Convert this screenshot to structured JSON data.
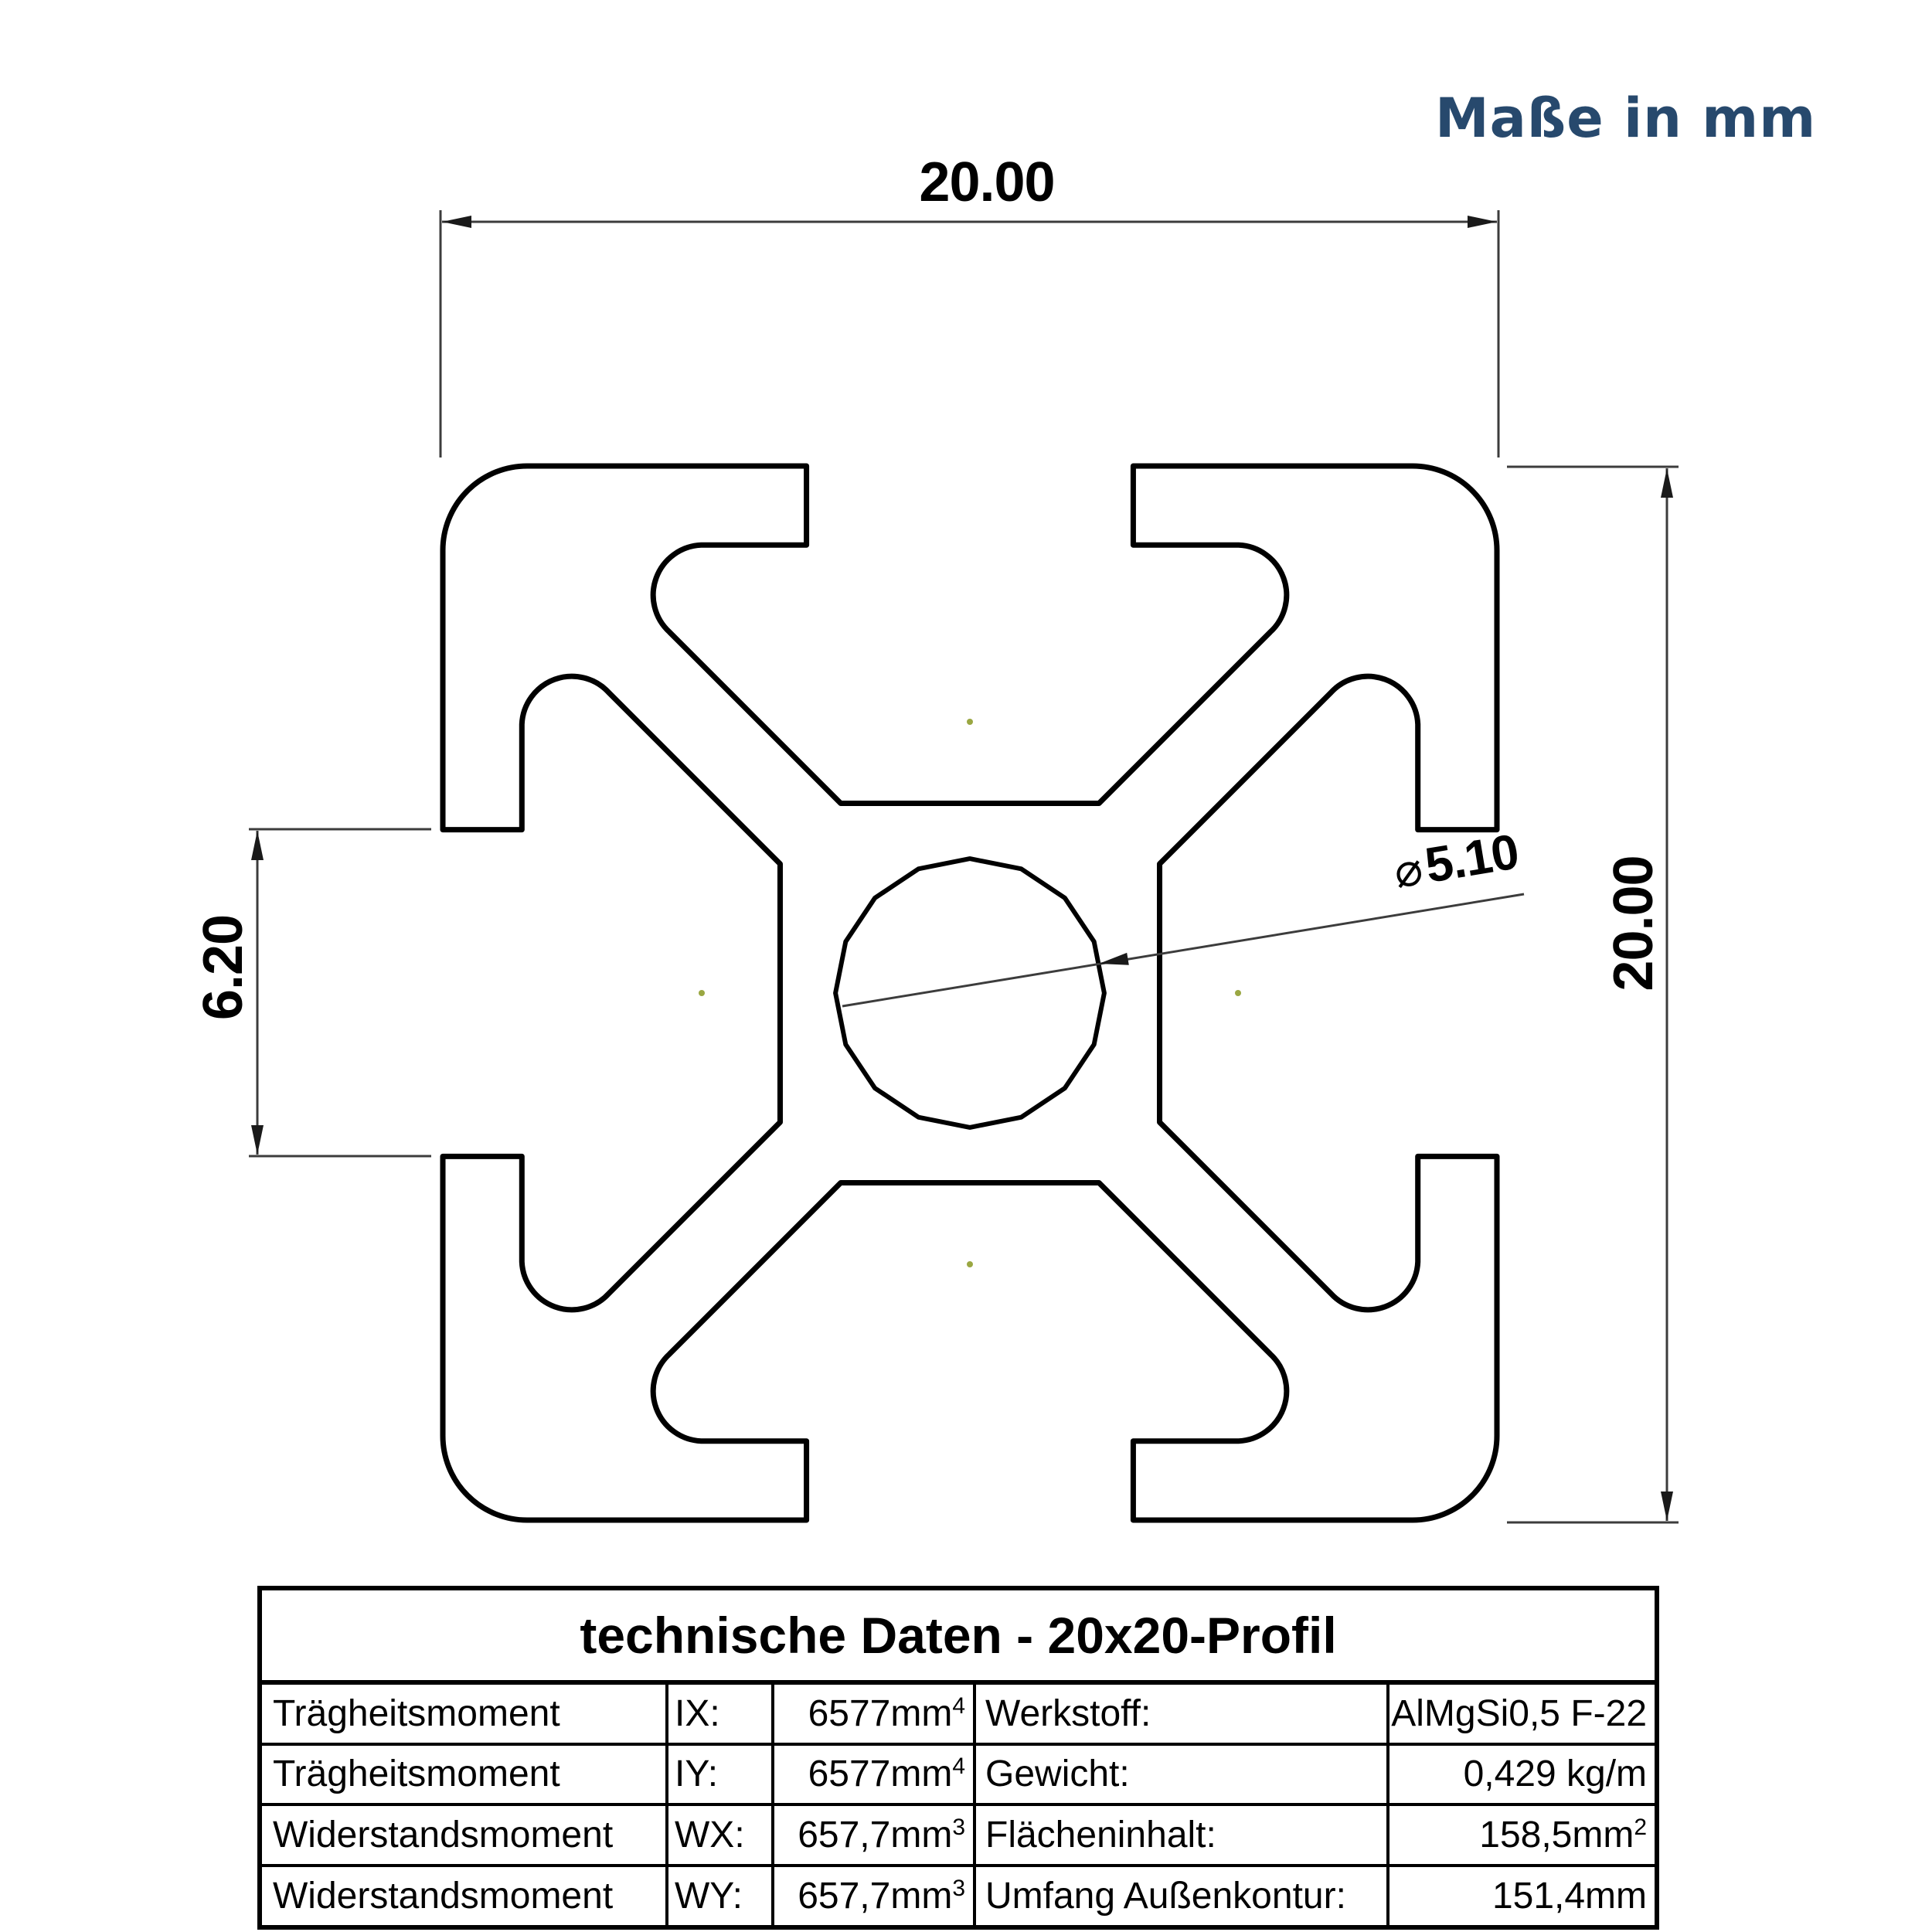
{
  "note": "Maße in mm",
  "dimensions": {
    "width": "20.00",
    "height": "20.00",
    "slot_width": "6.20",
    "hole_symbol": "⌀",
    "hole_diameter": "5.10"
  },
  "table": {
    "title": "technische Daten - 20x20-Profil",
    "rows": [
      {
        "label": "Trägheitsmoment",
        "symbol": "IX:",
        "value": "6577mm",
        "value_sup": "4",
        "label2": "Werkstoff:",
        "value2": "AlMgSi0,5 F-22",
        "value2_sup": ""
      },
      {
        "label": "Trägheitsmoment",
        "symbol": "IY:",
        "value": "6577mm",
        "value_sup": "4",
        "label2": "Gewicht:",
        "value2": "0,429 kg/m",
        "value2_sup": ""
      },
      {
        "label": "Widerstandsmoment",
        "symbol": "WX:",
        "value": "657,7mm",
        "value_sup": "3",
        "label2": "Flächeninhalt:",
        "value2": "158,5mm",
        "value2_sup": "2"
      },
      {
        "label": "Widerstandsmoment",
        "symbol": "WY:",
        "value": "657,7mm",
        "value_sup": "3",
        "label2": "Umfang Außenkontur:",
        "value2": "151,4mm",
        "value2_sup": ""
      }
    ]
  },
  "colors": {
    "annotation_blue": "#27496d",
    "line_dark": "#3c3c3c",
    "dot_olive": "#9aa742",
    "profile_line": "#000000"
  }
}
